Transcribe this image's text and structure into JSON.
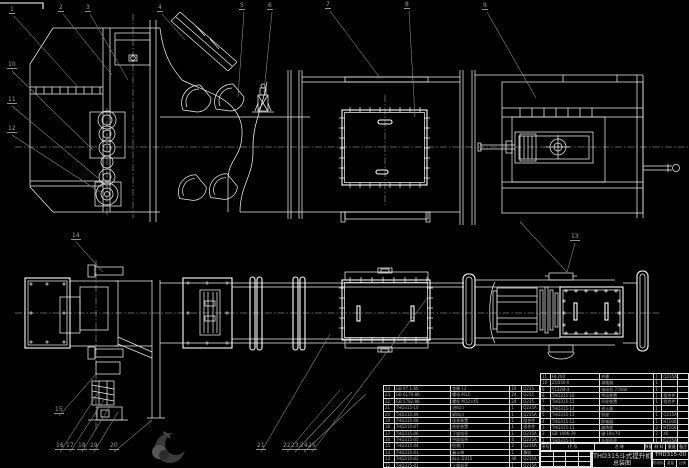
{
  "drawing": {
    "background_color": "#000000",
    "line_color": "#ededed",
    "leader_color": "#8f8f8f",
    "description": "CAD assembly drawing of TH315 bucket elevator, front elevation above and plan view below"
  },
  "title_block": {
    "product_title": "THD315斗式提升机",
    "drawing_type": "总装图",
    "drawing_no": "THD315-00",
    "stage_label": "阶段标记",
    "weight_label": "重量",
    "scale_label": "比例"
  },
  "bom": {
    "header": [
      "序号",
      "代 号",
      "名 称",
      "数量",
      "材 料",
      "重量",
      "备注"
    ],
    "left_rows": [
      {
        "seq": "24",
        "code": "GB 97.1-85",
        "name": "垫圈 12",
        "qty": "24",
        "mat": "Q235"
      },
      {
        "seq": "23",
        "code": "GB 6170-86",
        "name": "螺母 M12",
        "qty": "24",
        "mat": "Q235"
      },
      {
        "seq": "22",
        "code": "GB 5782-86",
        "name": "螺栓 M12×45",
        "qty": "24",
        "mat": "Q235"
      },
      {
        "seq": "21",
        "code": "THD315-10",
        "name": "进料口",
        "qty": "1",
        "mat": "Q235A"
      },
      {
        "seq": "20",
        "code": "THD315-09",
        "name": "卸料口",
        "qty": "1",
        "mat": "Q235A"
      },
      {
        "seq": "19",
        "code": "THD315-08",
        "name": "张紧装置",
        "qty": "1",
        "mat": "组合件"
      },
      {
        "seq": "18",
        "code": "THD315-07",
        "name": "底轮装置",
        "qty": "1",
        "mat": "组合件"
      },
      {
        "seq": "17",
        "code": "THD315-06",
        "name": "下部机壳",
        "qty": "1",
        "mat": "Q235A"
      },
      {
        "seq": "16",
        "code": "THD315-05",
        "name": "中部机壳",
        "qty": "4",
        "mat": "Q235A"
      },
      {
        "seq": "15",
        "code": "THD315-04",
        "name": "检视门",
        "qty": "2",
        "mat": "Q235A"
      },
      {
        "seq": "14",
        "code": "THD315-03",
        "name": "畚斗带",
        "qty": "1",
        "mat": "橡胶"
      },
      {
        "seq": "13",
        "code": "THD315-02",
        "name": "料斗 D315",
        "qty": "46",
        "mat": "Q235A"
      },
      {
        "seq": "12",
        "code": "THD315-01",
        "name": "上部机壳",
        "qty": "1",
        "mat": "Q235A"
      }
    ],
    "right_rows": [
      {
        "seq": "11",
        "code": "HJ-200",
        "name": "护罩",
        "qty": "1",
        "mat": "Q235A",
        "wt": ""
      },
      {
        "seq": "10",
        "code": "ZQ350-Ⅱ",
        "name": "减速器",
        "qty": "1",
        "mat": "",
        "wt": ""
      },
      {
        "seq": "9",
        "code": "Y132M-4",
        "name": "电动机 7.5kW",
        "qty": "1",
        "mat": "",
        "wt": ""
      },
      {
        "seq": "8",
        "code": "THD315-16",
        "name": "传动装置",
        "qty": "1",
        "mat": "组合件",
        "wt": ""
      },
      {
        "seq": "7",
        "code": "THD315-15",
        "name": "头轮装置",
        "qty": "1",
        "mat": "组合件",
        "wt": ""
      },
      {
        "seq": "6",
        "code": "THD315-14",
        "name": "逆止器",
        "qty": "1",
        "mat": "",
        "wt": ""
      },
      {
        "seq": "5",
        "code": "THD315-13",
        "name": "机座",
        "qty": "1",
        "mat": "Q235A",
        "wt": ""
      },
      {
        "seq": "4",
        "code": "THD315-12",
        "name": "联轴器",
        "qty": "1",
        "mat": "HT200",
        "wt": ""
      },
      {
        "seq": "3",
        "code": "THD315-11",
        "name": "轴承座",
        "qty": "2",
        "mat": "HT200",
        "wt": ""
      },
      {
        "seq": "2",
        "code": "GB 1096-79",
        "name": "键 18×70",
        "qty": "2",
        "mat": "45",
        "wt": ""
      },
      {
        "seq": "1",
        "code": "THD315-17",
        "name": "头部机壳",
        "qty": "1",
        "mat": "Q235A",
        "wt": ""
      }
    ]
  },
  "balloons": [
    {
      "n": "1",
      "x": 12,
      "y": 12,
      "tx": 78,
      "ty": 87
    },
    {
      "n": "2",
      "x": 61,
      "y": 10,
      "tx": 112,
      "ty": 75
    },
    {
      "n": "3",
      "x": 88,
      "y": 10,
      "tx": 128,
      "ty": 80
    },
    {
      "n": "4",
      "x": 160,
      "y": 10,
      "tx": 185,
      "ty": 40
    },
    {
      "n": "5",
      "x": 242,
      "y": 8,
      "tx": 238,
      "ty": 97
    },
    {
      "n": "6",
      "x": 270,
      "y": 8,
      "tx": 264,
      "ty": 92
    },
    {
      "n": "7",
      "x": 328,
      "y": 7,
      "tx": 380,
      "ty": 78
    },
    {
      "n": "8",
      "x": 407,
      "y": 7,
      "tx": 415,
      "ty": 117
    },
    {
      "n": "9",
      "x": 485,
      "y": 8,
      "tx": 536,
      "ty": 98
    },
    {
      "n": "10",
      "x": 10,
      "y": 67,
      "tx": 93,
      "ty": 150
    },
    {
      "n": "11",
      "x": 10,
      "y": 102,
      "tx": 98,
      "ty": 178
    },
    {
      "n": "12",
      "x": 10,
      "y": 131,
      "tx": 100,
      "ty": 192
    },
    {
      "n": "13",
      "x": 573,
      "y": 239,
      "tx": 567,
      "ty": 272
    },
    {
      "n": "14",
      "x": 74,
      "y": 238,
      "tx": 103,
      "ty": 272
    },
    {
      "n": "15",
      "x": 57,
      "y": 412,
      "tx": 97,
      "ty": 373
    },
    {
      "n": "16",
      "x": 58,
      "y": 448,
      "tx": 98,
      "ty": 393
    },
    {
      "n": "17",
      "x": 68,
      "y": 448,
      "tx": 104,
      "ty": 400
    },
    {
      "n": "18",
      "x": 80,
      "y": 448,
      "tx": 110,
      "ty": 406
    },
    {
      "n": "19",
      "x": 92,
      "y": 448,
      "tx": 118,
      "ty": 412
    },
    {
      "n": "20",
      "x": 112,
      "y": 448,
      "tx": 152,
      "ty": 420
    },
    {
      "n": "21",
      "x": 259,
      "y": 448,
      "tx": 330,
      "ty": 334
    },
    {
      "n": "22",
      "x": 285,
      "y": 448,
      "tx": 340,
      "ty": 390
    },
    {
      "n": "23",
      "x": 293,
      "y": 448,
      "tx": 352,
      "ty": 392
    },
    {
      "n": "24",
      "x": 302,
      "y": 448,
      "tx": 366,
      "ty": 394
    },
    {
      "n": "25",
      "x": 310,
      "y": 448,
      "tx": 428,
      "ty": 297
    }
  ]
}
